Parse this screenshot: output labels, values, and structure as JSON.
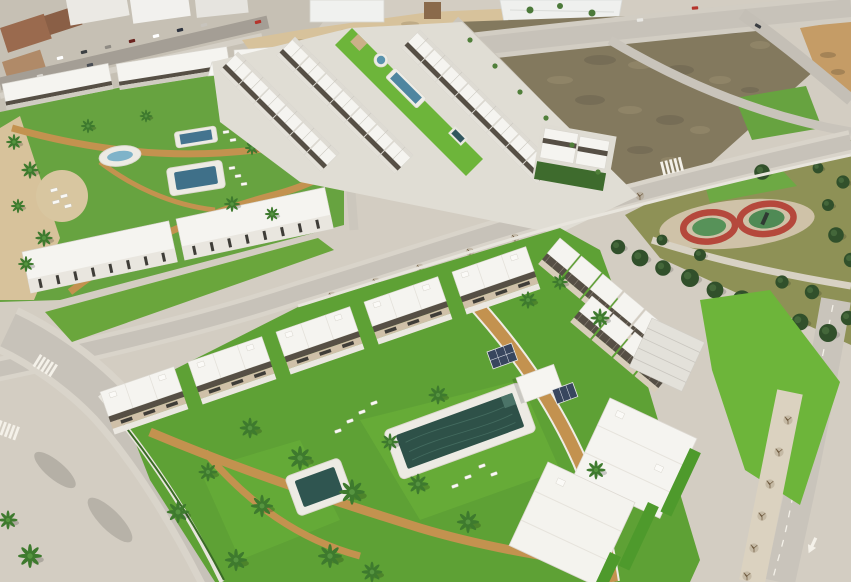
{
  "scene": {
    "description": "Aerial 3D render of a new-build coastal residential development: white apartment blocks and townhouse rows with communal lawns, swimming pools and palm trees, beside an existing town street, vacant dirt plots, asphalt roads and a public park with a red playground track and pine trees.",
    "regions": {
      "existing_town": "existing-town-street",
      "vacant_lots": "vacant-dirt-plots",
      "nw_complex": "northwest-apartment-complex",
      "townhouse_rows": "townhouse-rows-with-lap-pool",
      "park": "public-park-with-playground",
      "main_complex": "foreground-complex-with-main-pool",
      "se_complex": "southeast-apartment-blocks",
      "roads": "asphalt-roads-with-markings"
    },
    "colors": {
      "base": "#d3cdc2",
      "town_block": "#ebe9e4",
      "street_dark": "#a49e95",
      "sidewalk": "#d9d4ca",
      "road": "#c7c2b9",
      "marking": "#f4f1e9",
      "sand": "#d7c29b",
      "dirt": "#83795e",
      "dirt_orange": "#c59c66",
      "park_grass": "#8e9156",
      "park_lawn": "#67a340",
      "lawn": "#5ea135",
      "lawn_bright": "#6db53a",
      "hedge": "#3a6b26",
      "path_tan": "#c3924f",
      "plaza_sand": "#d8c6a0",
      "roof_white": "#f5f4f0",
      "facade": "#e9e6df",
      "facade_shadow": "#cfcbc2",
      "terrace_tan": "#cfc0a8",
      "pergola": "#564f45",
      "window_dark": "#3f3d38",
      "pool_deck": "#edebe4",
      "pool_dark": "#2e5148",
      "pool_blue": "#3f7089",
      "pool_teal": "#44748f",
      "pool_light": "#7fb3c9",
      "track_red": "#b5483c",
      "court_green": "#579259",
      "playground_base": "#cfc2a8",
      "roof_brown": "#9a6a4e",
      "palm_dark": "#3e7a2e",
      "palm_light": "#569540",
      "trunk": "#8a6b46",
      "pine": "#31502b",
      "pine_light": "#44673a",
      "shed_tan": "#cbb089",
      "panel_blue": "#38465e",
      "car_red": "#b5342c",
      "white_building": "#f0f1ef",
      "tower_brown": "#8a6a4b"
    }
  }
}
